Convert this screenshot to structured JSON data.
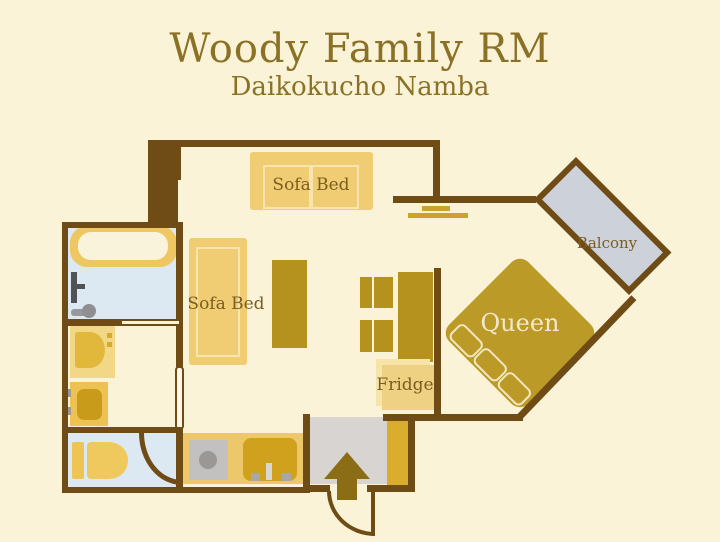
{
  "header": {
    "title": "Woody Family RM",
    "subtitle": "Daikokucho Namba"
  },
  "labels": {
    "sofa_bed_top": "Sofa Bed",
    "sofa_bed_left": "Sofa Bed",
    "balcony": "Balcony",
    "queen_bed": "Queen",
    "fridge": "Fridge"
  },
  "colors": {
    "background": "#FAF3D8",
    "wall": "#6F4B16",
    "heading_text": "#8A7125",
    "label_text": "#7A5D20",
    "bed_label_text": "#F2E8CC",
    "furniture_light_gold": "#F0CD72",
    "furniture_dark_gold": "#B5921D",
    "queen_bed_gold": "#BC9A28",
    "wet_room_floor": "#DDE9F2",
    "balcony_floor": "#CDD1DA",
    "entrance_floor": "#D7D4D1",
    "entrance_arrow": "#8A6D15"
  }
}
